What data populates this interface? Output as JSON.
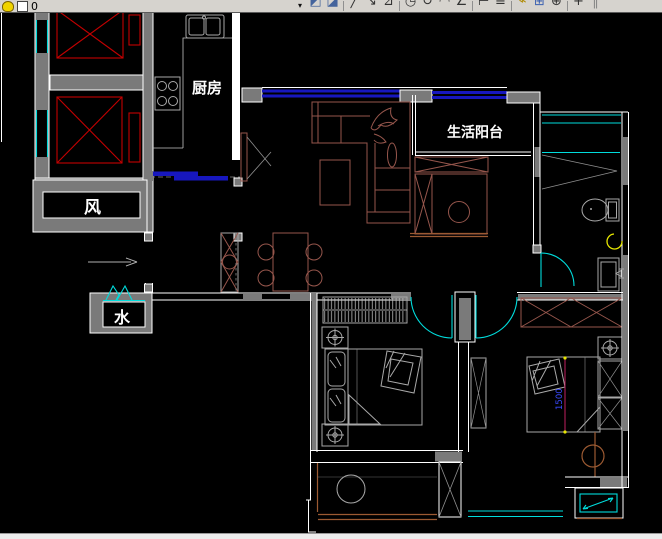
{
  "toolbar": {
    "layer_field": {
      "value": "0"
    },
    "dropdown_glyph": "▾",
    "icons": [
      {
        "name": "make-object-layer-current-icon",
        "glyph": "◩",
        "color": "#44639c"
      },
      {
        "name": "layer-previous-icon",
        "glyph": "◪",
        "color": "#44639c"
      },
      {
        "name": "separator",
        "glyph": ""
      },
      {
        "name": "draw-line-icon",
        "glyph": "╱",
        "color": "#333333"
      },
      {
        "name": "draw-polyline-icon",
        "glyph": "↘",
        "color": "#333333"
      },
      {
        "name": "edit-polyline-icon",
        "glyph": "⊿",
        "color": "#333333"
      },
      {
        "name": "separator",
        "glyph": ""
      },
      {
        "name": "circle-tool-icon",
        "glyph": "◷",
        "color": "#333333"
      },
      {
        "name": "rotate-tool-icon",
        "glyph": "↻",
        "color": "#333333"
      },
      {
        "name": "arc-tool-icon",
        "glyph": "◠",
        "color": "#333333"
      },
      {
        "name": "measure-angle-icon",
        "glyph": "∠",
        "color": "#333333"
      },
      {
        "name": "separator",
        "glyph": ""
      },
      {
        "name": "dim-linear-icon",
        "glyph": "⊢",
        "color": "#333333"
      },
      {
        "name": "dim-continue-icon",
        "glyph": "≡",
        "color": "#333333"
      },
      {
        "name": "separator",
        "glyph": ""
      },
      {
        "name": "match-properties-icon",
        "glyph": "⌁",
        "color": "#b08a00"
      },
      {
        "name": "insert-block-icon",
        "glyph": "⊞",
        "color": "#3a5fb0"
      },
      {
        "name": "center-snap-icon",
        "glyph": "⊕",
        "color": "#333333"
      },
      {
        "name": "separator",
        "glyph": ""
      },
      {
        "name": "pan-icon",
        "glyph": "+",
        "color": "#333333"
      },
      {
        "name": "toolbar-end-grip",
        "glyph": "‖",
        "color": "#888888"
      }
    ]
  },
  "canvas": {
    "background": "#000000"
  },
  "colors": {
    "toolbar_bg": "#d6d3ce",
    "wall_gray": "#7a7a7a",
    "line_white": "#ffffff",
    "elevator_red": "#c40000",
    "cad_cyan": "#00dcdc",
    "window_blue": "#1717be",
    "furniture_brown": "#96564c",
    "rail_orange": "#9c5a32",
    "furniture_gray": "#a9a9a9",
    "accent_yellow": "#e6e600",
    "dimension_magenta": "#c02060",
    "dimension_text_blue": "#3a4bff"
  },
  "floorplan": {
    "labels": {
      "kitchen": "厨房",
      "living_balcony": "生活阳台",
      "air_shaft": "风",
      "water_shaft": "水",
      "bed_dimension": "1500"
    }
  }
}
